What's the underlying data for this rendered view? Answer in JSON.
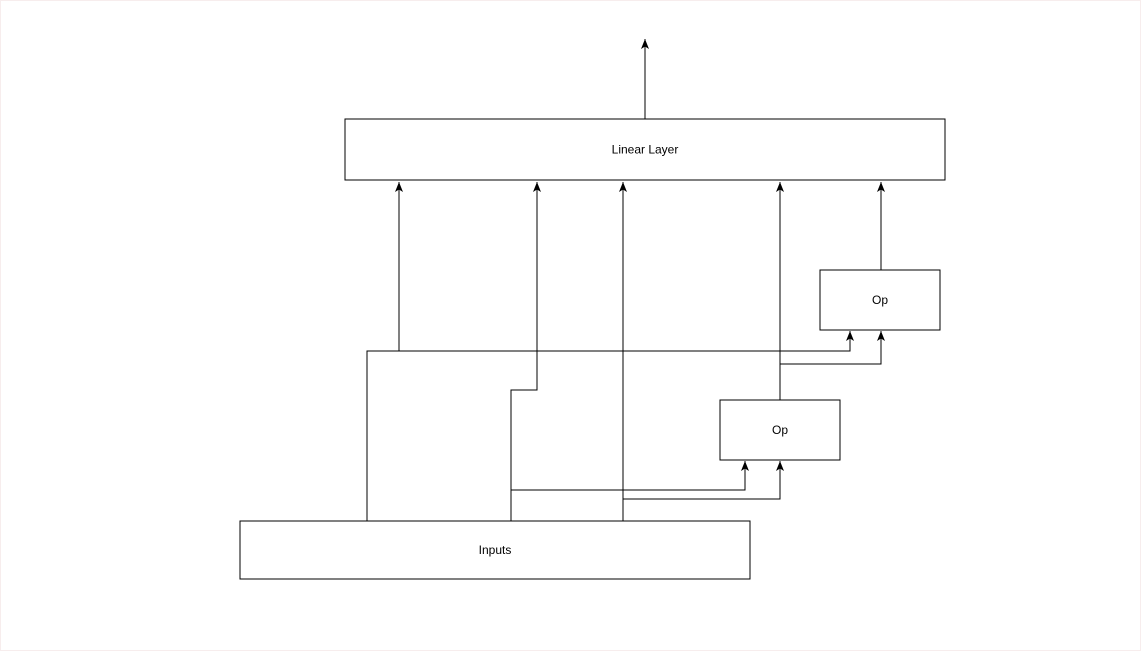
{
  "diagram": {
    "title": "Linear layer with op inputs diagram",
    "background_color": "#ffffff",
    "page_border_color": "#f7eded",
    "stroke_color": "#000000",
    "node_fill_color": "#ffffff",
    "text_color": "#000000",
    "nodes": [
      {
        "id": "linear-layer",
        "label": "Linear Layer",
        "x": 345,
        "y": 119,
        "w": 600,
        "h": 61
      },
      {
        "id": "op-1",
        "label": "Op",
        "x": 820,
        "y": 270,
        "w": 120,
        "h": 60
      },
      {
        "id": "op-2",
        "label": "Op",
        "x": 720,
        "y": 400,
        "w": 120,
        "h": 60
      },
      {
        "id": "inputs",
        "label": "Inputs",
        "x": 240,
        "y": 521,
        "w": 510,
        "h": 58
      }
    ],
    "edges": [
      {
        "id": "linear-layer-output",
        "points": [
          [
            645,
            119
          ],
          [
            645,
            39
          ]
        ]
      },
      {
        "id": "inputs-to-linear-left",
        "points": [
          [
            367,
            521
          ],
          [
            367,
            351
          ],
          [
            399,
            351
          ],
          [
            399,
            182
          ]
        ]
      },
      {
        "id": "inputs-to-op1",
        "points": [
          [
            367,
            521
          ],
          [
            367,
            351
          ],
          [
            850,
            351
          ],
          [
            850,
            331
          ]
        ]
      },
      {
        "id": "inputs-to-linear-mid",
        "points": [
          [
            511,
            521
          ],
          [
            511,
            390
          ],
          [
            537,
            390
          ],
          [
            537,
            182
          ]
        ]
      },
      {
        "id": "inputs-to-op2-left",
        "points": [
          [
            511,
            521
          ],
          [
            511,
            490
          ],
          [
            745,
            490
          ],
          [
            745,
            461
          ]
        ]
      },
      {
        "id": "inputs-to-linear-center",
        "points": [
          [
            623,
            521
          ],
          [
            623,
            182
          ]
        ]
      },
      {
        "id": "inputs-to-op2-right",
        "points": [
          [
            623,
            521
          ],
          [
            623,
            499
          ],
          [
            780,
            499
          ],
          [
            780,
            461
          ]
        ]
      },
      {
        "id": "op2-to-linear",
        "points": [
          [
            780,
            400
          ],
          [
            780,
            182
          ]
        ]
      },
      {
        "id": "op2-to-op1",
        "points": [
          [
            780,
            400
          ],
          [
            780,
            364
          ],
          [
            881,
            364
          ],
          [
            881,
            331
          ]
        ]
      },
      {
        "id": "op1-to-linear",
        "points": [
          [
            881,
            270
          ],
          [
            881,
            182
          ]
        ]
      }
    ]
  }
}
